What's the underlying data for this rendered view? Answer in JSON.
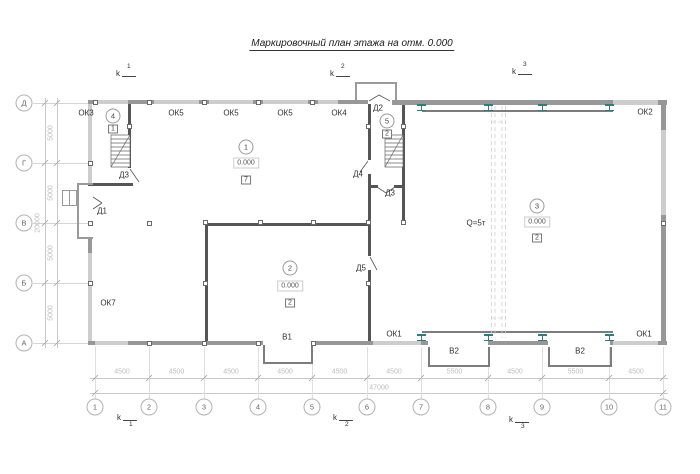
{
  "title": "Маркировочный план этажа на отм. 0.000",
  "axes": {
    "columns": [
      "1",
      "2",
      "3",
      "4",
      "5",
      "6",
      "7",
      "8",
      "9",
      "10",
      "11"
    ],
    "rows": [
      "Д",
      "Г",
      "В",
      "Б",
      "А"
    ]
  },
  "dimensions": {
    "column_spacing": [
      "4500",
      "4500",
      "4500",
      "4500",
      "4500",
      "4500",
      "5500",
      "4500",
      "5500",
      "4500"
    ],
    "total_width": "47000",
    "row_spacing": [
      "5000",
      "5000",
      "5000",
      "5000"
    ],
    "total_height": "20000"
  },
  "section_marks": [
    {
      "letter": "k",
      "number": "1"
    },
    {
      "letter": "k",
      "number": "2"
    },
    {
      "letter": "k",
      "number": "3"
    }
  ],
  "window_labels": [
    "ОК3",
    "ОК5",
    "ОК5",
    "ОК5",
    "ОК4",
    "ОК2",
    "ОК7",
    "ОК1",
    "ОК1"
  ],
  "door_labels": [
    "Д1",
    "Д2",
    "Д3",
    "Д3",
    "Д4",
    "Д5"
  ],
  "gate_labels": [
    "В1",
    "В2",
    "В2"
  ],
  "rooms": [
    {
      "number": "1",
      "elevation": "0.000",
      "floor_type": "7"
    },
    {
      "number": "2",
      "elevation": "0.000",
      "floor_type": "2"
    },
    {
      "number": "3",
      "elevation": "0.000",
      "floor_type": "2"
    },
    {
      "number": "4",
      "floor_type": "1"
    },
    {
      "number": "5",
      "floor_type": "2"
    }
  ],
  "crane_label": "Q=5т",
  "colors": {
    "steel_column": "#2e7d7e",
    "wall_solid": "#979797",
    "wall_window": "#cdcdcd",
    "wall_partition": "#555555",
    "dimension_text": "#bdbdbd"
  }
}
